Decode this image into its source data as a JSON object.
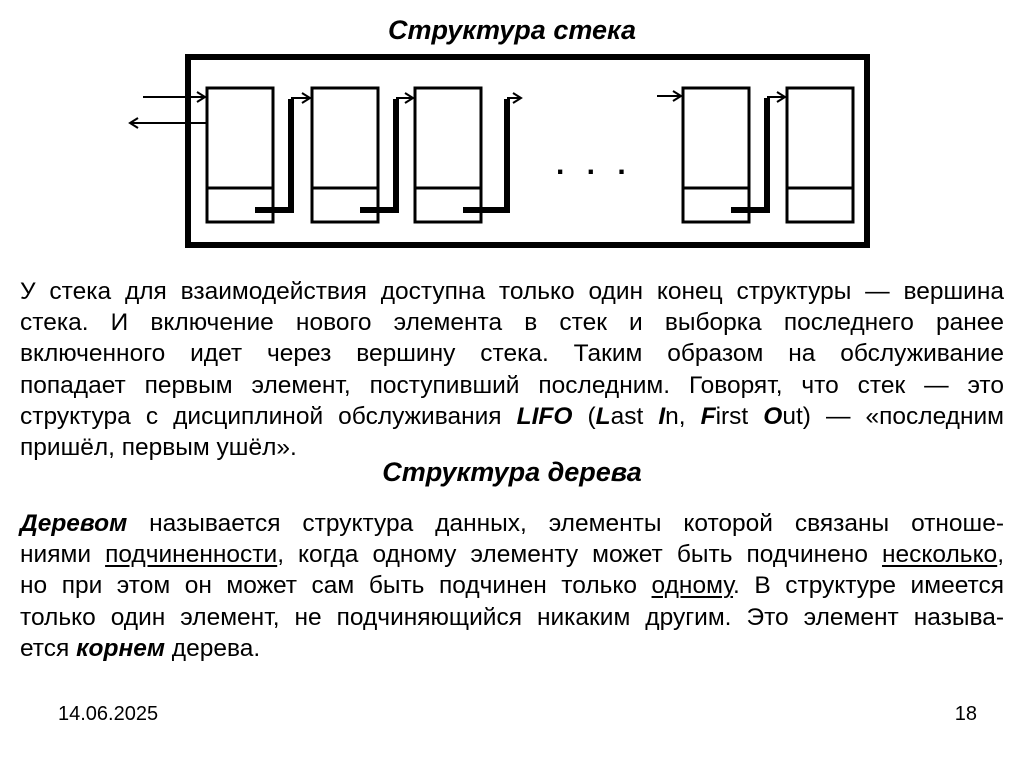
{
  "title": "Структура стека",
  "tree_title": "Структура дерева",
  "diagram": {
    "ellipsis": ". . ."
  },
  "stack_paragraph": {
    "lines": [
      {
        "justify": true,
        "segments": [
          {
            "text": "У стека для взаимодействия доступна только один конец структуры — вершина",
            "style": "r"
          }
        ]
      },
      {
        "justify": true,
        "segments": [
          {
            "text": "стека. И включение нового элемента в стек и выборка последнего ранее",
            "style": "r"
          }
        ]
      },
      {
        "justify": true,
        "segments": [
          {
            "text": "включенного идет через вершину стека. Таким образом на обслуживание",
            "style": "r"
          }
        ]
      },
      {
        "justify": true,
        "segments": [
          {
            "text": "попадает первым элемент, поступивший последним. Говорят, что стек — это",
            "style": "r"
          }
        ]
      },
      {
        "justify": true,
        "segments": [
          {
            "text": "структура с дисциплиной обслуживания ",
            "style": "r"
          },
          {
            "text": "LIFO",
            "style": "bi"
          },
          {
            "text": " (",
            "style": "r"
          },
          {
            "text": "L",
            "style": "bi"
          },
          {
            "text": "ast ",
            "style": "r"
          },
          {
            "text": "I",
            "style": "bi"
          },
          {
            "text": "n, ",
            "style": "r"
          },
          {
            "text": "F",
            "style": "bi"
          },
          {
            "text": "irst ",
            "style": "r"
          },
          {
            "text": "O",
            "style": "bi"
          },
          {
            "text": "ut) — «последним",
            "style": "r"
          }
        ]
      },
      {
        "justify": false,
        "segments": [
          {
            "text": "пришёл, первым ушёл».",
            "style": "r"
          }
        ]
      }
    ]
  },
  "tree_paragraph": {
    "lines": [
      {
        "justify": true,
        "segments": [
          {
            "text": "Деревом",
            "style": "bi"
          },
          {
            "text": " называется структура данных, элементы которой связаны отноше-",
            "style": "r"
          }
        ]
      },
      {
        "justify": true,
        "segments": [
          {
            "text": "ниями ",
            "style": "r"
          },
          {
            "text": "подчиненности",
            "style": "u"
          },
          {
            "text": ", когда одному элементу может быть подчинено ",
            "style": "r"
          },
          {
            "text": "несколько",
            "style": "u"
          },
          {
            "text": ",",
            "style": "r"
          }
        ]
      },
      {
        "justify": true,
        "segments": [
          {
            "text": "но при этом он может сам быть подчинен только ",
            "style": "r"
          },
          {
            "text": "одному",
            "style": "u"
          },
          {
            "text": ". В структуре имеется",
            "style": "r"
          }
        ]
      },
      {
        "justify": true,
        "segments": [
          {
            "text": "только один элемент, не подчиняющийся никаким другим. Это элемент называ-",
            "style": "r"
          }
        ]
      },
      {
        "justify": false,
        "segments": [
          {
            "text": "ется ",
            "style": "r"
          },
          {
            "text": "корнем",
            "style": "bi"
          },
          {
            "text": " дерева.",
            "style": "r"
          }
        ]
      }
    ]
  },
  "footer": {
    "date": "14.06.2025",
    "page_number": "18"
  }
}
